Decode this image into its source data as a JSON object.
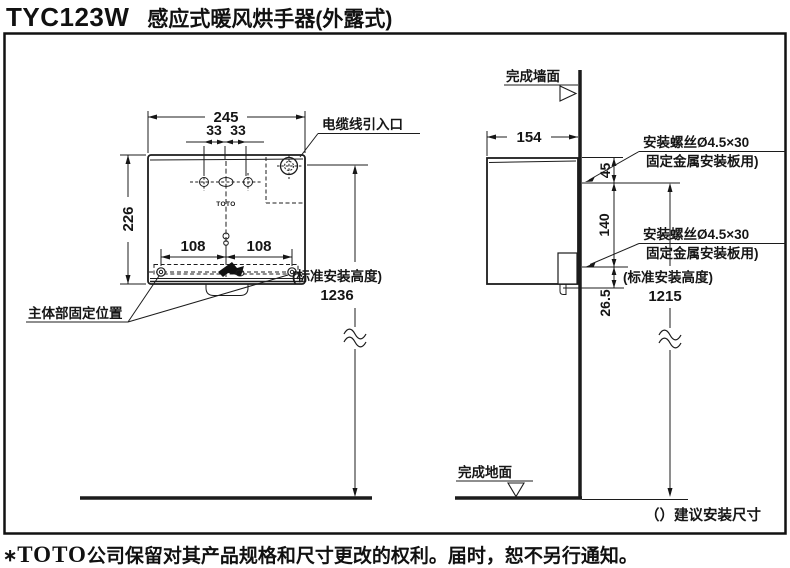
{
  "title": {
    "model": "TYC123W",
    "product": "感应式暖风烘手器(外露式)"
  },
  "front_view": {
    "width": "245",
    "hole_offset_left": "33",
    "hole_offset_right": "33",
    "height": "226",
    "bottom_hole_left": "108",
    "bottom_hole_right": "108",
    "cable_entry_label": "电缆线引入口",
    "body_fixing_label": "主体部固定位置",
    "install_height_note": "(标准安装高度)",
    "install_height": "1236",
    "logo": "TOTO"
  },
  "side_view": {
    "wall_label": "完成墙面",
    "floor_label": "完成地面",
    "depth": "154",
    "screw_top_offset": "45",
    "screw_spacing": "140",
    "screw_bottom_offset": "26.5",
    "screw_label_line1": "安装螺丝Ø4.5×30",
    "screw_label_line2": "固定金属安装板用)",
    "install_height_note": "(标准安装高度)",
    "install_height": "1215",
    "legend": "（）建议安装尺寸"
  },
  "footer": {
    "mark": "∗",
    "brand": "TOTO",
    "text": "公司保留对其产品规格和尺寸更改的权利。届时，恕不另行通知。"
  }
}
